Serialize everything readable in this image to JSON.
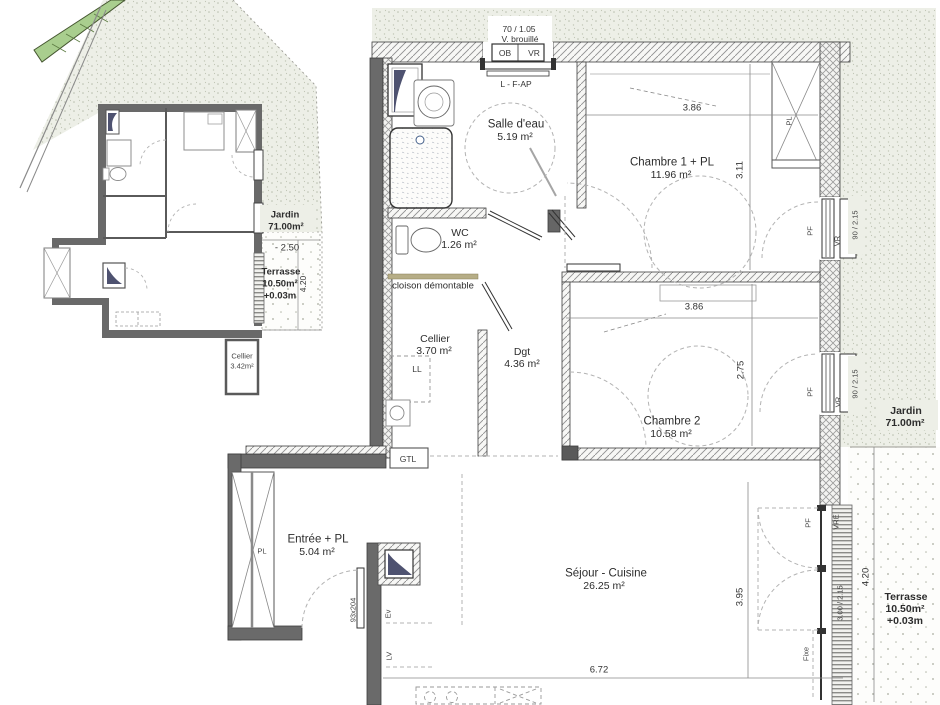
{
  "site": {
    "jardin_name": "Jardin",
    "jardin_area": "71.00m²",
    "level": "- 2.50",
    "terrasse_name": "Terrasse",
    "terrasse_area": "10.50m²",
    "terrasse_level": "+0.03m",
    "terrasse_dim": "4.20",
    "cellier_name": "Cellier",
    "cellier_area": "3.42m²"
  },
  "top_window": {
    "dim": "70 / 1.05",
    "note": "V. brouillé",
    "ob": "OB",
    "vr": "VR",
    "under": "L - F-AP"
  },
  "rooms": {
    "salle_eau": {
      "name": "Salle d'eau",
      "area": "5.19 m²"
    },
    "chambre1": {
      "name": "Chambre 1 + PL",
      "area": "11.96 m²",
      "width": "3.86",
      "depth": "3.11"
    },
    "wc": {
      "name": "WC",
      "area": "1.26 m²"
    },
    "cellier": {
      "name": "Cellier",
      "area": "3.70 m²"
    },
    "dgt": {
      "name": "Dgt",
      "area": "4.36 m²"
    },
    "chambre2": {
      "name": "Chambre 2",
      "area": "10.58 m²",
      "width": "3.86",
      "depth": "2.75"
    },
    "entree": {
      "name": "Entrée + PL",
      "area": "5.04 m²"
    },
    "sejour": {
      "name": "Séjour - Cuisine",
      "area": "26.25 m²",
      "width": "6.72",
      "depth": "3.95"
    }
  },
  "annotations": {
    "cloison": "cloison démontable",
    "ll": "LL",
    "gtl": "GTL",
    "ev": "Ev",
    "lv": "LV",
    "pl_chambre1": "PL",
    "pl_entree": "PL",
    "door_size": "93x204",
    "fixe": "Fixe"
  },
  "windows": {
    "win1": {
      "pf": "PF",
      "vr": "VR",
      "dim": "90 / 2.15"
    },
    "win2": {
      "pf": "PF",
      "vr": "VR",
      "dim": "90 / 2.15"
    },
    "bay": {
      "pf": "PF",
      "vre": "VRE",
      "dim": "3.00 / 2.15"
    }
  },
  "exterior": {
    "jardin_name": "Jardin",
    "jardin_area": "71.00m²",
    "terrasse_name": "Terrasse",
    "terrasse_area": "10.50m²",
    "terrasse_level": "+0.03m",
    "terrasse_dim": "4.20"
  }
}
